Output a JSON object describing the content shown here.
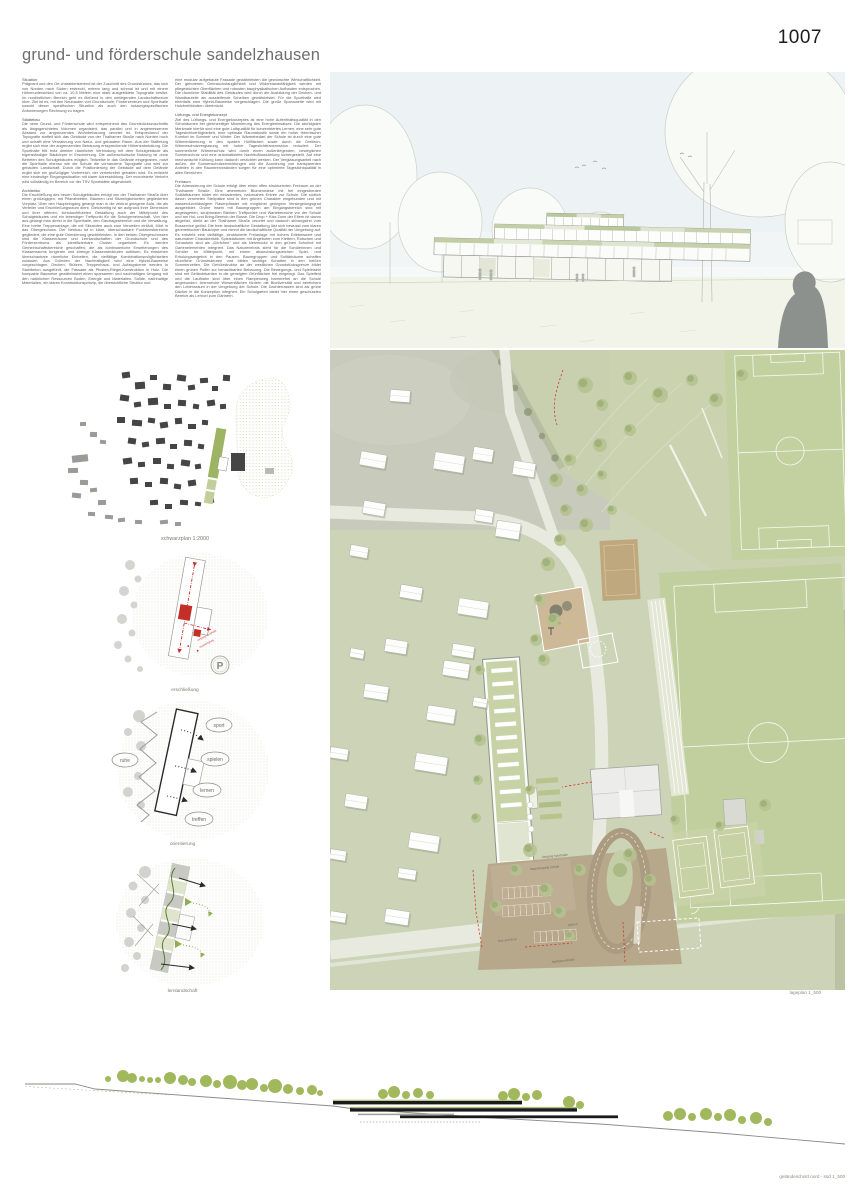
{
  "page": {
    "number": "1007",
    "title": "grund- und förderschule sandelzhausen"
  },
  "essay": {
    "col1": [
      {
        "heading": "Situation",
        "body": "Prägnant und den Ort charakterisierend ist der Zuschnitt des Grundstückes, das sich von Norden nach Süden erstreckt, extrem lang und schmal ist und mit einem Höhenunterschied von ca. 10,5 Metern eine stark ausgebildete Topografie besitzt. Im nordöstlichen Bereich geht es fließend in den umliegenden Landschaftsraum über. Ziel ist es, mit den Neubauten von Grundschule, Förderzentrum und Sporthalle sowohl dieser spezifischen Situation als auch den nutzungsspezifischen Anforderungen Rechnung zu tragen."
      },
      {
        "heading": "Städtebau",
        "body": "Die neue Grund- und Förderschule wird entsprechend des Grundstückszuschnitts als längsgerichtetes Volumen organisiert, das parallel und in angemessenem Abstand zur angrenzenden Wohnbebauung verortet ist. Entsprechend der Topografie staffelt sich das Gebäude von der Thalhamer Straße nach Norden hoch und schafft eine Verzahnung von Natur- und gebautem Raum. Aus der Staffelung ergibt sich eine der angrenzenden Bebauung entsprechende Höhenentwicklung. Die Sporthalle tritt trotz direkter räumlicher Verbindung mit dem Schulgebäude als eigenständiger Baukörper in Erscheinung. Die außerschulische Nutzung ist ohne Betreten des Schulgebäudes möglich. Teilweise in das Gelände eingegraben, nutzt die Sporthalle ebenso wie die Schule die vorhandene Topografie und wird zur gebauten Landschaft. Durch die Positionierung der Gebäude auf dem Gelände ergibt sich ein großzügiger Vorbereich, der verkehrsfrei gehalten wird. Es entsteht eine eindeutige Eingangssituation mit klarer Adressbildung. Der motorisierte Verkehr wird vollständig im Bereich vor der TSV Sportstätte abgewickelt."
      },
      {
        "heading": "Architektur",
        "body": "Die Erschließung des neuen Schulgebäudes erfolgt von der Thalhamer Straße über einen großzügigen, mit Pflanzbeeten, Bäumen und Sitzmöglichkeiten gegliederten Vorplatz. Über den Haupteingang gelangt man in die zentral gelegene Aula, die als Verteiler und Erschließungsraum dient. Gleichzeitig ist sie aufgrund ihrer Dimension und ihrer offenen, lichtdurchfluteten Gestaltung auch der Mittelpunkt des Schulgebäudes und ein lebendiger Treffpunkt für die Schulgemeinschaft. Von hier aus gelangt man direkt in die Sporthalle, den Ganztagesbereich und die Verwaltung. Eine breite Treppenanlage, die mit Sitzstufen auch zum Verweilen einlädt, führt in das Obergeschoss. Der Neubau ist in klare, überschaubare Funktionsbereiche gegliedert, die eine gute Orientierung gewährleisten. In den beiden Obergeschossen sind die Klassenräume und Lernlandschaften der Grundschule und des Förderzentrums als identifizierbare Cluster organisiert. Es werden Gemeinschaftsbereiche geschaffen, die als kontinuierliche Erweiterungen des Klassenraums fungieren und strenge Klassenstrukturen auflösen. Es entstehen überschaubare räumliche Einheiten, die vielfältige Kombinationsmöglichkeiten zulassen. Aus Gründen der Nachhaltigkeit wird eine Hybrid-Bauweise vorgeschlagen. Decken, Stützen, Treppenhaus- und Aufzugskerne werden in Stahlbeton ausgeführt, die Fassade als Pfosten-Riegel-Konstruktion in Holz. Die kompakte Bauweise gewährleistet einen sparsamen und nachhaltigen Umgang mit den natürlichen Ressourcen Boden, Energie und Materialien. Solide, nachhaltige Materialien, ein klares Konstruktionsprinzip, die übersichtliche Struktur und"
      }
    ],
    "col2": [
      {
        "heading": "",
        "body": "eine modular aufgebaute Fassade gewährleisten die gewünschte Wirtschaftlichkeit. Der gebotenen Gebrauchstauglichkeit und Widerstandsfähigkeit werden mit pflegeleichten Oberflächen und robusten bauphysikalischen Aufbauten entsprochen. Die räumliche Stabilität des Gebäudes wird durch die Ausbildung der Decken- und Wandbauteile als aussteifende Scheiben gewährleistet. Für die Sporthalle wird ebenfalls eine Hybrid-Bauweise vorgeschlagen. Die große Spannweite wird mit Holzbrettbindern überbrückt."
      },
      {
        "heading": "Lüftungs- und Energiekonzept",
        "body": "Ziel des Lüftungs- und Energiekonzeptes ist eine hohe Aufenthaltsqualität in den Schulräumen bei gleichzeitiger Minimierung des Energieeinsatzes. Die wichtigsten Merkmale hierfür sind eine gute Luftqualität für konzentriertes Lernen, eine sehr gute Tageslichtverfügbarkeit, eine optimale Raumakustik sowie ein hoher thermischer Komfort im Sommer und Winter. Der Wärmebedarf der Schule ist durch eine gute Wärmedämmung in den opaken Hüllflächen sowie durch die Dreifach-Wärmeschutzverglasung mit hoher Tageslichttransmission reduziert. Der sommerliche Wärmeschutz wird durch einen außenliegenden, beweglichen Sonnenschutz und eine automatisierte Nachtluftauskühlung sichergestellt. Auf eine mechanische Kühlung kann dadurch verzichtet werden. Der Verglasungsanteil nach außen, die Sonnenschutzeinrichtungen und die Anordnung von transparenten Anteilen in den Raumtrennwänden sorgen für eine optimierte Tageslichtqualität in allen Bereichen."
      },
      {
        "heading": "Freiraum",
        "body": "Die Adressierung der Schule erfolgt über einen offen strukturierten Freiraum an der Thalhamer Straße. Eine artenreiche Blumenwiese mit frei eingestreuten Solitärbäumen bildet ein einladendes, naturnahes Entree zur Schule. Die südlich davon verorteten Stellplätze sind in den grünen Charakter eingebunden und mit wasserdurchlässigem Rasenpflaster mit möglichst geringem Versiegelungsgrad ausgebildet. Grüne Inseln mit Baumgruppen am Eingangsbereich sind mit angelagerten, skulpturalen Bänken Treffpunkte und Wartebereiche vor der Schule und am Hol- und Bring-Bereich der Busse. Die Drop + Kiss Zone der Eltern ist davon abgelöst, direkt an der Thalhamer Straße verortet und dadurch störungsfrei vom Busservice gelöst. Die freie landschaftliche Gestaltung löst sich bewusst vom klaren geometrischen Baukörper und nimmt die landschaftliche Qualität der Umgebung auf. Es entsteht eine vielfältige, strukturierte Freianlage mit hohem Erlebniswert und naturnaher Charakteristik. Spielstationen mit Angeboten zum Klettern, Rutschen und Schaukeln sind als „Dörfchen“ und als Netzmodul in den grünen Schulhof mit Gartenelementen integriert. Das Naturerlebnis steht für die Schülerinnen und Schüler im Mittelpunkt, mit einem abwechslungsreichen Spiel- und Erholungsangebot in den Pausen. Baumgruppen und Solitärbäume schaffen räumliche Grünstrukturen und bilden wichtige Schatten in den heißen Sommerzeiten. Die Gehölzstruktur an der westlichen Grundstücksgrenze bildet einen grünen Puffer zur benachbarten Bebauung. Die Bewegungs- und Spielinseln sind mit Geländekanten in die geneigten Grünflächen frei eingelegt. Das Spielfeld und die Laufbahn sind über einen Rampenweg barrierefrei an die Schule angebunden. Artenreiche Wiesenflächen fördern die Biodiversität und bereichern den Lebensraum in der Umgebung der Schule. Die Dachterrassen sind als grüne Dächer in die Konzeption integriert. Ein Schulgarten bietet hier einen geschützten Bereich als Lernort zum Gärtnern."
      }
    ]
  },
  "diagrams": {
    "schwarzplan": {
      "caption": "schwarzplan 1:2000"
    },
    "erschliessung": {
      "caption": "erschließung",
      "parking_symbol": "P",
      "label_hall_entry": "eingang sporthalle",
      "label_main_entry": "haupteingang"
    },
    "orientierung": {
      "caption": "orientierung",
      "zones": [
        "ruhe",
        "sport",
        "spielen",
        "lernen",
        "treffen"
      ]
    },
    "lernlandschaft": {
      "caption": "lernlandschaft"
    }
  },
  "siteplan": {
    "caption": "lageplan 1_500",
    "street": "thalhamerstraße",
    "label_kiss_drop": "kiss and drop",
    "label_parken": "parken",
    "label_hall_entry": "eingang sporthalle",
    "label_main_entry": "haupteingang schule"
  },
  "section": {
    "caption": "geländeschnitt nord - süd 1_500"
  },
  "colors": {
    "accent_red": "#d03a2c",
    "olive_green": "#a2b85c",
    "plan_green": "#ccd3b6",
    "dark_building": "#454545",
    "plaza_brown": "#b7a88c"
  }
}
